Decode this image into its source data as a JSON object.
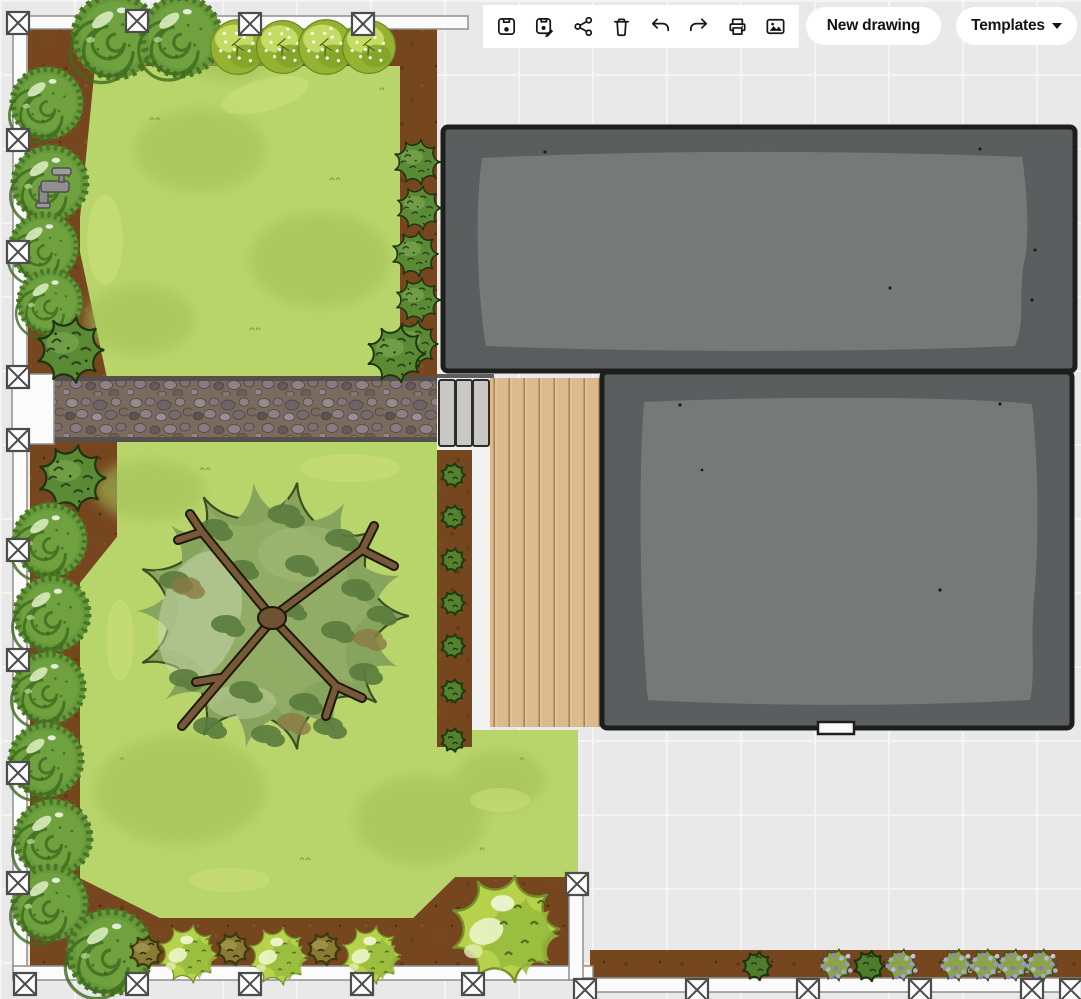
{
  "toolbar": {
    "new_drawing_label": "New drawing",
    "templates_label": "Templates",
    "icons": [
      "save-icon",
      "save-as-icon",
      "share-icon",
      "delete-icon",
      "undo-icon",
      "redo-icon",
      "print-icon",
      "export-image-icon"
    ]
  },
  "palette": {
    "canvas_bg": "#e9e9e9",
    "grid_line": "#f4f4f4",
    "lawn": "#b8d56b",
    "soil_bed": "#76471f",
    "building_fill": "#5a5e5e",
    "building_inner": "#757978",
    "deck_wood": "#dcba8d",
    "stone_path": "#7b6b5e",
    "fence_white": "#fbfbfb",
    "water_drop": "#3fb2ea"
  },
  "scene": {
    "handles": [
      [
        18,
        23
      ],
      [
        137,
        21
      ],
      [
        250,
        24
      ],
      [
        363,
        24
      ],
      [
        18,
        140
      ],
      [
        18,
        252
      ],
      [
        18,
        377
      ],
      [
        18,
        440
      ],
      [
        18,
        550
      ],
      [
        18,
        660
      ],
      [
        18,
        773
      ],
      [
        18,
        883
      ],
      [
        25,
        984
      ],
      [
        137,
        984
      ],
      [
        250,
        984
      ],
      [
        362,
        984
      ],
      [
        473,
        984
      ],
      [
        577,
        884
      ],
      [
        585,
        990
      ],
      [
        697,
        990
      ],
      [
        808,
        990
      ],
      [
        920,
        990
      ],
      [
        1032,
        990
      ],
      [
        1071,
        990
      ]
    ],
    "plants": [
      {
        "type": "spiral-bush",
        "x": 115,
        "y": 36,
        "s": 0.95
      },
      {
        "type": "spiral-bush",
        "x": 181,
        "y": 36,
        "s": 0.9
      },
      {
        "type": "flower-tree",
        "x": 238,
        "y": 47,
        "s": 0.62
      },
      {
        "type": "flower-tree",
        "x": 283,
        "y": 47,
        "s": 0.6
      },
      {
        "type": "flower-tree",
        "x": 326,
        "y": 47,
        "s": 0.62
      },
      {
        "type": "flower-tree",
        "x": 369,
        "y": 47,
        "s": 0.6
      },
      {
        "type": "spiral-bush",
        "x": 47,
        "y": 103,
        "s": 0.8
      },
      {
        "type": "spiral-bush",
        "x": 50,
        "y": 183,
        "s": 0.84
      },
      {
        "type": "tap",
        "x": 55,
        "y": 188,
        "s": 1
      },
      {
        "type": "spiral-bush",
        "x": 44,
        "y": 247,
        "s": 0.76
      },
      {
        "type": "spiral-bush",
        "x": 50,
        "y": 302,
        "s": 0.72
      },
      {
        "type": "hedge-bush",
        "x": 70,
        "y": 350,
        "s": 0.9
      },
      {
        "type": "hedge-bush",
        "x": 417,
        "y": 162,
        "s": 0.62
      },
      {
        "type": "hedge-bush",
        "x": 419,
        "y": 208,
        "s": 0.6
      },
      {
        "type": "hedge-bush",
        "x": 415,
        "y": 254,
        "s": 0.62
      },
      {
        "type": "hedge-bush",
        "x": 418,
        "y": 300,
        "s": 0.6
      },
      {
        "type": "hedge-bush",
        "x": 414,
        "y": 344,
        "s": 0.64
      },
      {
        "type": "hedge-bush",
        "x": 396,
        "y": 354,
        "s": 0.78
      },
      {
        "type": "hedge-bush",
        "x": 72,
        "y": 478,
        "s": 0.9
      },
      {
        "type": "small-shrub",
        "x": 453,
        "y": 475,
        "s": 0.95
      },
      {
        "type": "small-shrub",
        "x": 453,
        "y": 517,
        "s": 0.95
      },
      {
        "type": "small-shrub",
        "x": 453,
        "y": 560,
        "s": 0.95
      },
      {
        "type": "small-shrub",
        "x": 453,
        "y": 603,
        "s": 0.95
      },
      {
        "type": "small-shrub",
        "x": 453,
        "y": 646,
        "s": 0.95
      },
      {
        "type": "small-shrub",
        "x": 453,
        "y": 691,
        "s": 0.95
      },
      {
        "type": "small-shrub",
        "x": 453,
        "y": 740,
        "s": 0.95
      },
      {
        "type": "big-tree",
        "x": 272,
        "y": 616,
        "s": 1
      },
      {
        "type": "spiral-bush",
        "x": 50,
        "y": 540,
        "s": 0.82
      },
      {
        "type": "spiral-bush",
        "x": 52,
        "y": 614,
        "s": 0.84
      },
      {
        "type": "spiral-bush",
        "x": 49,
        "y": 688,
        "s": 0.8
      },
      {
        "type": "spiral-bush",
        "x": 46,
        "y": 760,
        "s": 0.82
      },
      {
        "type": "spiral-bush",
        "x": 53,
        "y": 838,
        "s": 0.86
      },
      {
        "type": "spiral-bush",
        "x": 50,
        "y": 903,
        "s": 0.84
      },
      {
        "type": "spiral-bush",
        "x": 110,
        "y": 952,
        "s": 0.95
      },
      {
        "type": "olive-shrub",
        "x": 146,
        "y": 952,
        "s": 1
      },
      {
        "type": "bright-bush",
        "x": 188,
        "y": 954,
        "s": 0.64
      },
      {
        "type": "olive-shrub",
        "x": 233,
        "y": 949,
        "s": 1
      },
      {
        "type": "bright-bush",
        "x": 278,
        "y": 956,
        "s": 0.64
      },
      {
        "type": "olive-shrub",
        "x": 324,
        "y": 949,
        "s": 1
      },
      {
        "type": "bright-bush",
        "x": 371,
        "y": 955,
        "s": 0.64
      },
      {
        "type": "bright-bush",
        "x": 505,
        "y": 929,
        "s": 1.17
      },
      {
        "type": "strip-green-bush",
        "x": 757,
        "y": 966,
        "s": 0.8
      },
      {
        "type": "purple-bush",
        "x": 836,
        "y": 965,
        "s": 0.55
      },
      {
        "type": "strip-green-bush",
        "x": 869,
        "y": 966,
        "s": 0.85
      },
      {
        "type": "purple-bush",
        "x": 901,
        "y": 965,
        "s": 0.55
      },
      {
        "type": "purple-bush",
        "x": 956,
        "y": 965,
        "s": 0.55
      },
      {
        "type": "purple-bush",
        "x": 985,
        "y": 965,
        "s": 0.55
      },
      {
        "type": "purple-bush",
        "x": 1013,
        "y": 965,
        "s": 0.55
      },
      {
        "type": "purple-bush",
        "x": 1041,
        "y": 965,
        "s": 0.55
      }
    ]
  }
}
